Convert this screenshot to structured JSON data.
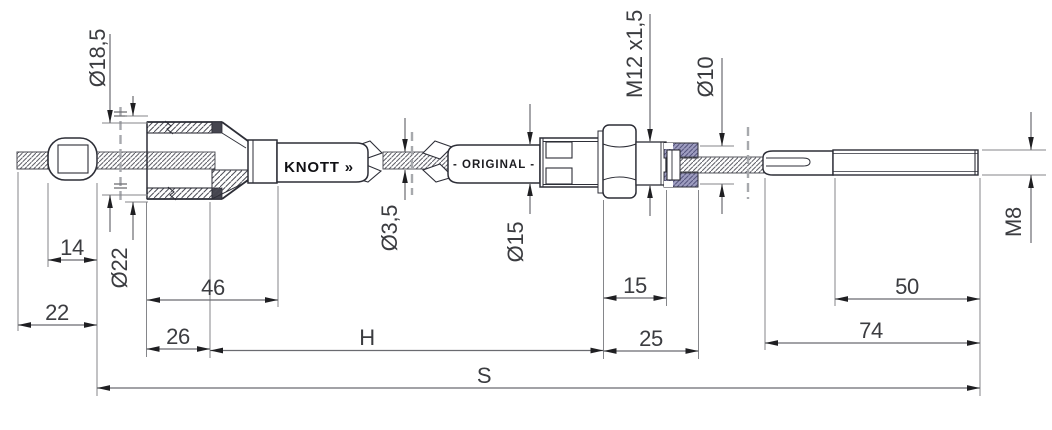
{
  "labels": {
    "brand": "KNOTT »",
    "sleeve": "- ORIGINAL -"
  },
  "dims": {
    "nipple_len": "14",
    "end_len": "22",
    "housing_len": "46",
    "housing_front": "26",
    "sheath_len": "H",
    "nut_len": "15",
    "adjuster_len": "25",
    "rod_thread_len": "50",
    "rod_total": "74",
    "total_len": "S",
    "dia_bell_inner": "Ø18,5",
    "dia_bell_outer": "Ø22",
    "dia_wire": "Ø3,5",
    "dia_conduit": "Ø15",
    "thread_adjuster": "M12 x1,5",
    "dia_abutment": "Ø10",
    "thread_rod": "M8"
  }
}
